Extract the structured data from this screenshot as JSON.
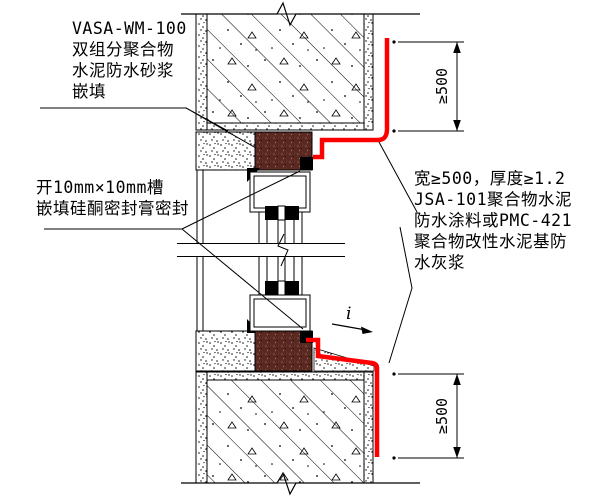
{
  "drawing": {
    "labels": {
      "top_left_lines": [
        "VASA-WM-100",
        "双组分聚合物",
        "水泥防水砂浆",
        "嵌填"
      ],
      "mid_left_lines": [
        "开10mm×10mm槽",
        "嵌填硅酮密封膏密封"
      ],
      "right_lines": [
        "宽≥500，厚度≥1.2",
        "JSA-101聚合物水泥",
        "防水涂料或PMC-421",
        "聚合物改性水泥基防",
        "水灰浆"
      ],
      "dim_top": "≥500",
      "dim_bottom": "≥500",
      "slope_label": "i"
    },
    "colors": {
      "line": "#000000",
      "background": "#ffffff",
      "waterproof_red": "#fe0000",
      "sealant_black": "#000000",
      "polymer_mortar_maroon": "#5a2a22"
    }
  }
}
